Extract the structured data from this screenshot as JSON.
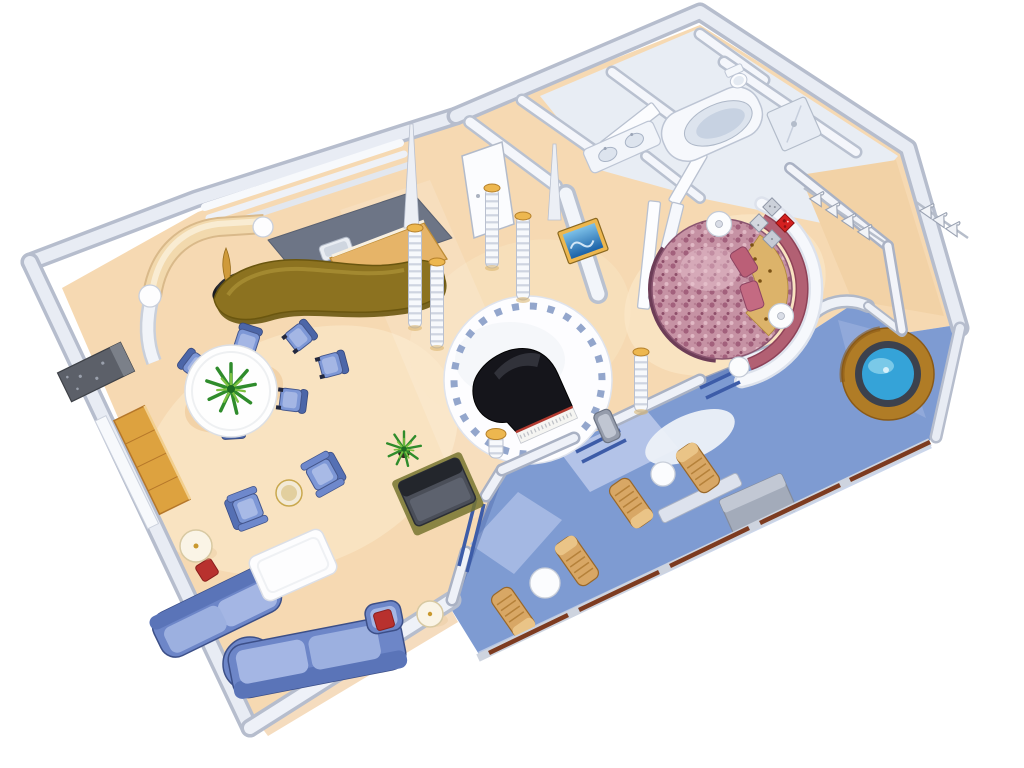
{
  "canvas": {
    "width": 1024,
    "height": 768,
    "background": "#ffffff"
  },
  "palette": {
    "background": "#ffffff",
    "floor": "#f6d9b2",
    "floorLight": "#fae6c6",
    "floorShadow": "#eec493",
    "wallTop": "#eef1f8",
    "wallEdge": "#aab2c4",
    "wallOuter": "#b6bdcd",
    "slateWall": "#6d7586",
    "bathFloor": "#e8edf4",
    "deck": "#7e9bd2",
    "deckLight": "#b9c8ea",
    "deckDark": "#5a74b2",
    "sofa": "#6d86c8",
    "sofaCushion": "#a4b6e4",
    "chairBlue": "#7d97d6",
    "bar": "#8c7220",
    "barBack": "#e6b468",
    "creamWall": "#f2d9ad",
    "cabinetWood": "#dda23f",
    "teak": "#d8a765",
    "gold": "#edb74f",
    "piano": "#15151b",
    "tileRing": "#93a6cc",
    "bed": "#c692a4",
    "headboard": "#b26073",
    "leopard": "#dcb36a",
    "accentRed": "#b8312e",
    "artRed": "#d42020",
    "water": "#35a3d8",
    "tubWood": "#b07c26",
    "railing": "#7d3b20",
    "tvScreen": "#2b7fca",
    "plant": "#3f9b35",
    "lampShade": "#faf4e6"
  },
  "scene": {
    "type": "isometric-floor-plan",
    "subject": "luxury-suite-cutaway",
    "rotation_degrees": -24,
    "rooms": [
      "living-dining-room",
      "wet-bar",
      "entry-foyer",
      "piano-lounge",
      "master-bedroom",
      "bathroom",
      "walk-in-closet",
      "private-balcony",
      "whirlpool-area"
    ],
    "inventory": {
      "sectional_sofa": 1,
      "accent_pillows_red": 2,
      "coffee_table": 1,
      "armchairs": 2,
      "side_table": 1,
      "floor_lamps": 2,
      "dining_table": 1,
      "dining_chairs": 6,
      "potted_plants": 2,
      "bar_counter": 1,
      "back_bar": 1,
      "sculpture": 1,
      "media_cabinet": 1,
      "decorative_columns": 6,
      "grand_piano": 1,
      "piano_bench": 1,
      "round_bed": 1,
      "nightstands": 2,
      "wall_art_diamonds": 4,
      "clothes_hangers": 7,
      "bathtub": 1,
      "sinks": 2,
      "toilet": 1,
      "shower": 1,
      "balcony_lounge_chairs": 4,
      "balcony_tables": 2,
      "whirlpool_tub": 1,
      "balcony_partitions": 1
    }
  }
}
